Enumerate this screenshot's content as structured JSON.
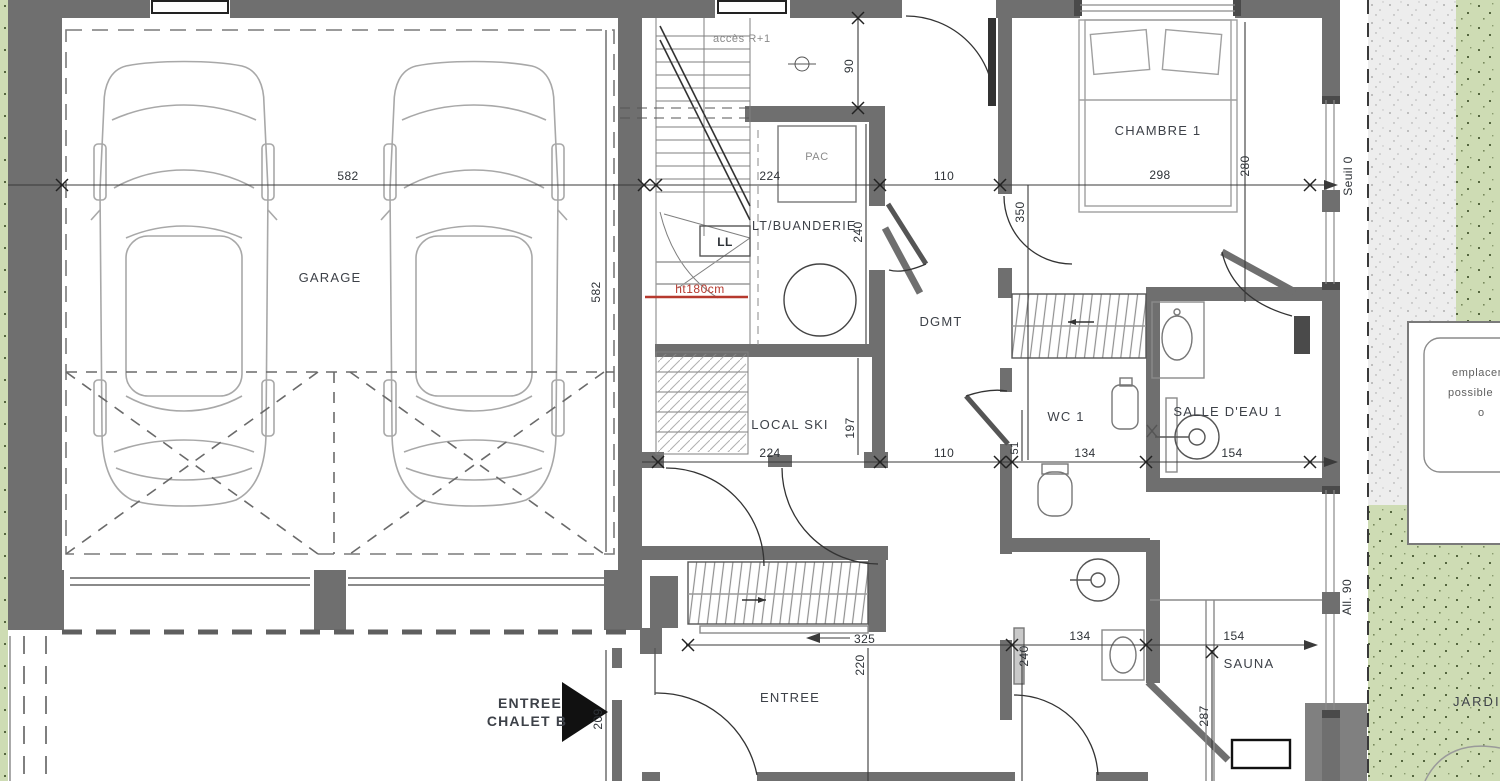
{
  "colors": {
    "wall": "#6f6f6f",
    "wall_dark": "#4a4a4a",
    "line_dark": "#2b2b2b",
    "line_light": "#a8a8a8",
    "green": "#cedcb4",
    "green_dot": "#55663f",
    "terrace": "#ededed",
    "red": "#b6392e",
    "path_gray": "#808080"
  },
  "rooms": {
    "garage": "GARAGE",
    "pac": "PAC",
    "ll": "LL",
    "buanderie": "LT/BUANDERIE",
    "local_ski": "LOCAL SKI",
    "dgmt": "DGMT",
    "chambre1": "CHAMBRE 1",
    "wc1": "WC 1",
    "salle_deau1": "SALLE D'EAU 1",
    "entree": "ENTREE",
    "sauna": "SAUNA",
    "jardin": "JARDIN"
  },
  "ann": {
    "acces": "accès R+1",
    "ht180": "ht180cm",
    "seuil": "Seuil 0",
    "all90": "All. 90",
    "entree_chalet_1": "ENTREE",
    "entree_chalet_2": "CHALET B",
    "empl_1": "emplacement",
    "empl_2": "possible",
    "empl_3": "o"
  },
  "dims": {
    "garage_w": "582",
    "garage_v": "582",
    "door90": "90",
    "bu_w": "224",
    "bu_v": "240",
    "top110": "110",
    "ch_w": "298",
    "ch_v": "280",
    "wall350": "350",
    "ski_w": "224",
    "ski_v": "197",
    "mid110": "110",
    "seg51": "51",
    "wc_w": "134",
    "sde_w": "154",
    "ward325": "325",
    "ent_v": "220",
    "ent209": "209",
    "bath_w": "134",
    "bath_v": "240",
    "sauna_w": "154",
    "sauna_v": "287"
  }
}
